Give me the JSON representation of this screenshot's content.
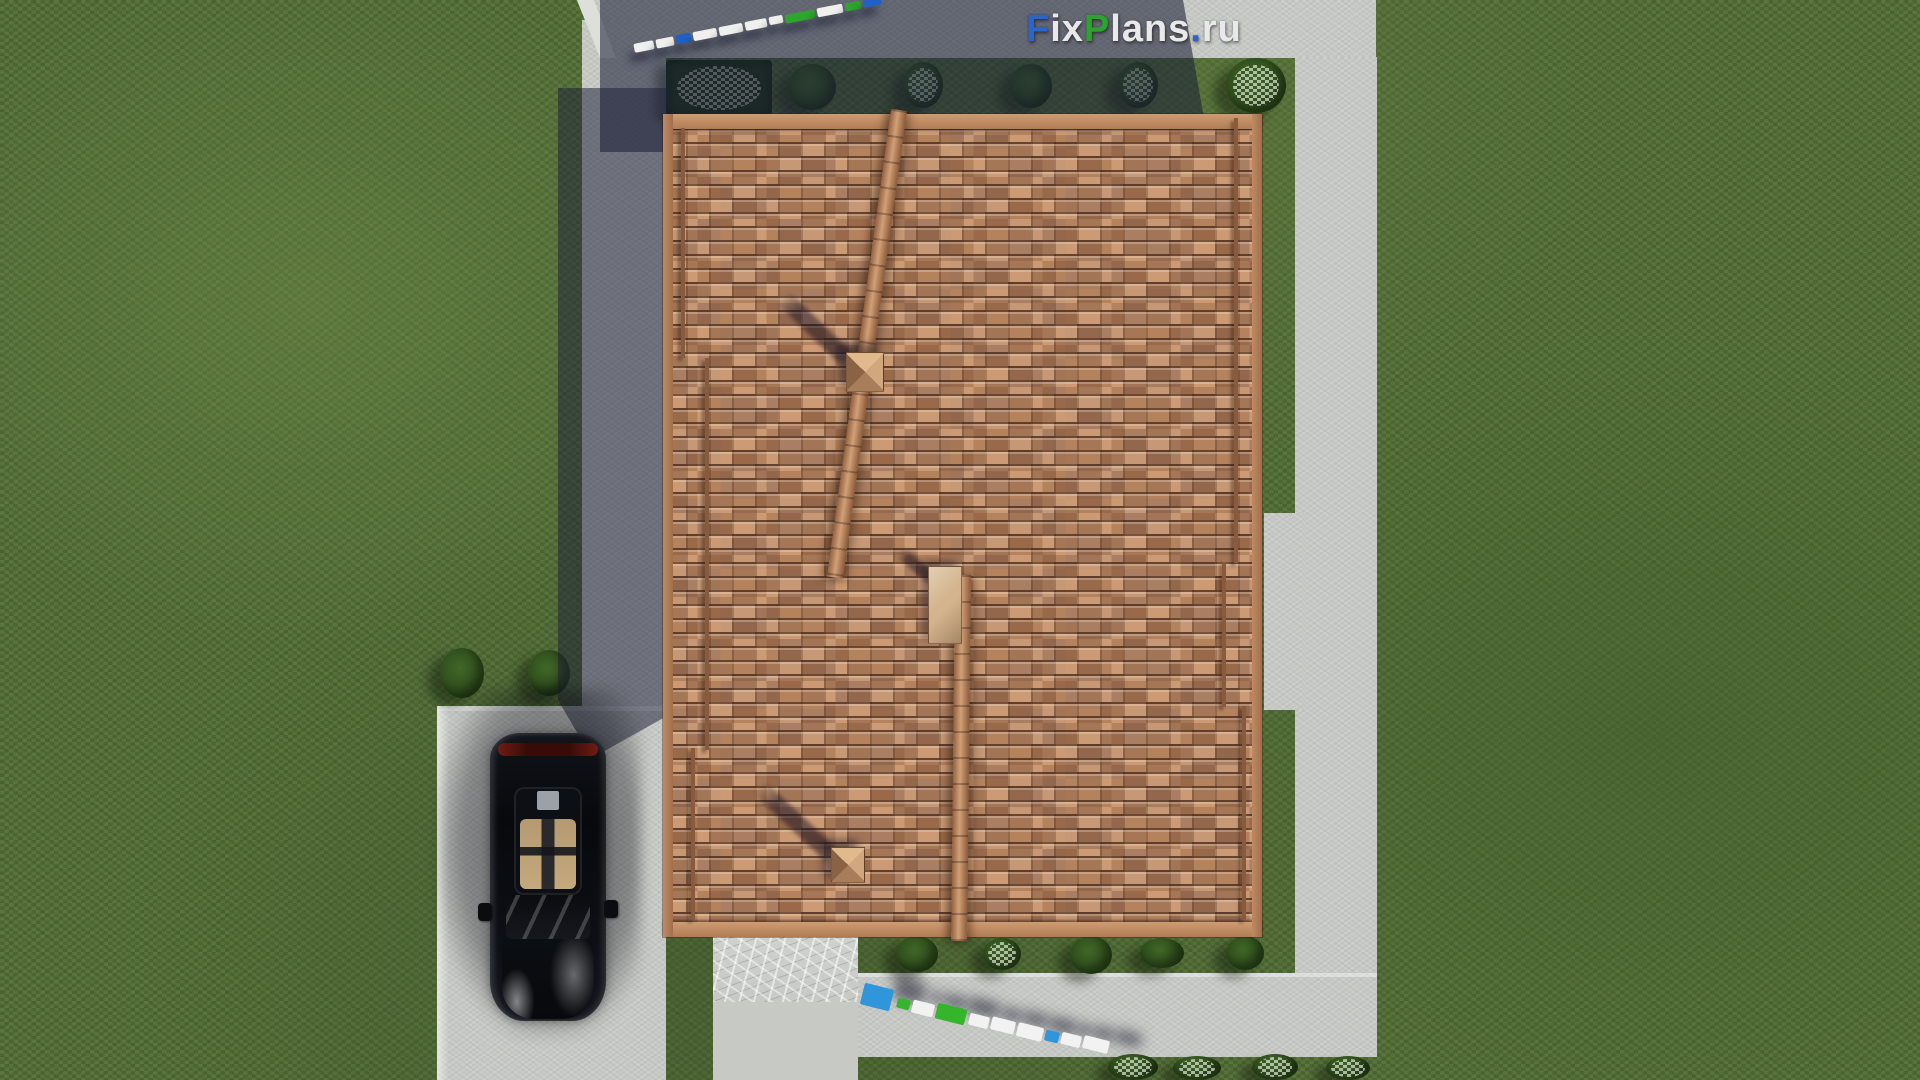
{
  "watermark": {
    "logo": {
      "text": "FixPlans.ru",
      "parts": [
        {
          "text": "F",
          "color": "#2b65c8"
        },
        {
          "text": "ix",
          "color": "#e9e9e9"
        },
        {
          "text": "P",
          "color": "#2ca32c"
        },
        {
          "text": "lans",
          "color": "#e9e9e9"
        },
        {
          "text": ".",
          "color": "#2b65c8"
        },
        {
          "text": "ru",
          "color": "#e9e9e9"
        }
      ]
    },
    "ground_text_top": {
      "text": "FixPlans.ru",
      "bars": [
        {
          "x": 634,
          "y": 42,
          "w": 20,
          "h": 9,
          "c": "#f0f0ee"
        },
        {
          "x": 656,
          "y": 38,
          "w": 18,
          "h": 9,
          "c": "#f0f0ee"
        },
        {
          "x": 676,
          "y": 34,
          "w": 15,
          "h": 9,
          "c": "#2160c4"
        },
        {
          "x": 693,
          "y": 30,
          "w": 24,
          "h": 9,
          "c": "#f0f0ee"
        },
        {
          "x": 719,
          "y": 25,
          "w": 24,
          "h": 9,
          "c": "#f0f0ee"
        },
        {
          "x": 745,
          "y": 20,
          "w": 22,
          "h": 9,
          "c": "#f0f0ee"
        },
        {
          "x": 769,
          "y": 16,
          "w": 14,
          "h": 8,
          "c": "#f0f0ee"
        },
        {
          "x": 785,
          "y": 12,
          "w": 30,
          "h": 9,
          "c": "#2ea52e"
        },
        {
          "x": 817,
          "y": 6,
          "w": 26,
          "h": 9,
          "c": "#f0f0ee"
        },
        {
          "x": 845,
          "y": 2,
          "w": 16,
          "h": 8,
          "c": "#2ea52e"
        },
        {
          "x": 863,
          "y": -3,
          "w": 18,
          "h": 9,
          "c": "#2160c4"
        }
      ]
    },
    "ground_text_bottom": {
      "text": "FixPlans.ru",
      "bars": [
        {
          "x": 862,
          "y": 986,
          "w": 30,
          "h": 22,
          "c": "#2f96dc"
        },
        {
          "x": 897,
          "y": 999,
          "w": 13,
          "h": 10,
          "c": "#35b52c"
        },
        {
          "x": 912,
          "y": 1002,
          "w": 22,
          "h": 13,
          "c": "#f2f2f2"
        },
        {
          "x": 936,
          "y": 1006,
          "w": 30,
          "h": 16,
          "c": "#35b52c"
        },
        {
          "x": 969,
          "y": 1015,
          "w": 20,
          "h": 12,
          "c": "#f2f2f2"
        },
        {
          "x": 991,
          "y": 1019,
          "w": 24,
          "h": 13,
          "c": "#f2f2f2"
        },
        {
          "x": 1017,
          "y": 1025,
          "w": 26,
          "h": 14,
          "c": "#f2f2f2"
        },
        {
          "x": 1045,
          "y": 1031,
          "w": 14,
          "h": 11,
          "c": "#2f96dc"
        },
        {
          "x": 1061,
          "y": 1034,
          "w": 20,
          "h": 12,
          "c": "#f2f2f2"
        },
        {
          "x": 1083,
          "y": 1038,
          "w": 26,
          "h": 13,
          "c": "#f2f2f2"
        }
      ]
    }
  },
  "colors": {
    "grass": "#57723b",
    "pavement": "#c9cbc7",
    "cast_shadow": "rgba(28,33,55,0.58)",
    "roof_tile": "#b5825e",
    "roof_trim": "#c28d66",
    "logo_blue": "#2b65c8",
    "logo_green": "#2ca32c",
    "logo_white": "#e9e9e9",
    "car_body": "#0b0d11",
    "car_interior": "#bf9f74",
    "car_taillight": "#6e1511"
  },
  "scene": {
    "bushes": [
      {
        "x": 788,
        "y": 64,
        "w": 48,
        "h": 46
      },
      {
        "x": 903,
        "y": 62,
        "w": 40,
        "h": 46,
        "cls": "fl"
      },
      {
        "x": 1010,
        "y": 64,
        "w": 42,
        "h": 44
      },
      {
        "x": 1118,
        "y": 62,
        "w": 40,
        "h": 46,
        "cls": "fl"
      },
      {
        "x": 1226,
        "y": 58,
        "w": 60,
        "h": 55,
        "cls": "fl"
      },
      {
        "x": 896,
        "y": 936,
        "w": 42,
        "h": 36
      },
      {
        "x": 983,
        "y": 938,
        "w": 38,
        "h": 32,
        "cls": "fl"
      },
      {
        "x": 1070,
        "y": 936,
        "w": 42,
        "h": 38
      },
      {
        "x": 1140,
        "y": 938,
        "w": 44,
        "h": 30
      },
      {
        "x": 1226,
        "y": 936,
        "w": 38,
        "h": 34
      },
      {
        "x": 1108,
        "y": 1054,
        "w": 50,
        "h": 26,
        "cls": "fl"
      },
      {
        "x": 1173,
        "y": 1056,
        "w": 48,
        "h": 24,
        "cls": "fl"
      },
      {
        "x": 1252,
        "y": 1054,
        "w": 46,
        "h": 26,
        "cls": "fl"
      },
      {
        "x": 1326,
        "y": 1056,
        "w": 44,
        "h": 24,
        "cls": "fl"
      },
      {
        "x": 440,
        "y": 648,
        "w": 44,
        "h": 50
      },
      {
        "x": 528,
        "y": 650,
        "w": 42,
        "h": 46
      }
    ],
    "roof_battens": [
      {
        "x": 681,
        "y": 128,
        "w": 4,
        "h": 230
      },
      {
        "x": 705,
        "y": 358,
        "w": 4,
        "h": 392
      },
      {
        "x": 691,
        "y": 748,
        "w": 4,
        "h": 172
      },
      {
        "x": 1234,
        "y": 118,
        "w": 4,
        "h": 445
      },
      {
        "x": 1222,
        "y": 562,
        "w": 4,
        "h": 145
      },
      {
        "x": 1242,
        "y": 706,
        "w": 4,
        "h": 214
      }
    ],
    "chimneys": [
      {
        "x": 846,
        "y": 352,
        "w": 38,
        "h": 40,
        "cls": "pyr"
      },
      {
        "x": 928,
        "y": 566,
        "w": 34,
        "h": 78,
        "cls": "hatch"
      },
      {
        "x": 831,
        "y": 847,
        "w": 34,
        "h": 36,
        "cls": "pyr"
      }
    ],
    "chimney_shadows": [
      {
        "x": 782,
        "y": 288,
        "w": 95,
        "h": 17,
        "r": 44
      },
      {
        "x": 900,
        "y": 546,
        "w": 44,
        "h": 12,
        "r": 40
      },
      {
        "x": 758,
        "y": 778,
        "w": 102,
        "h": 17,
        "r": 43
      }
    ]
  }
}
